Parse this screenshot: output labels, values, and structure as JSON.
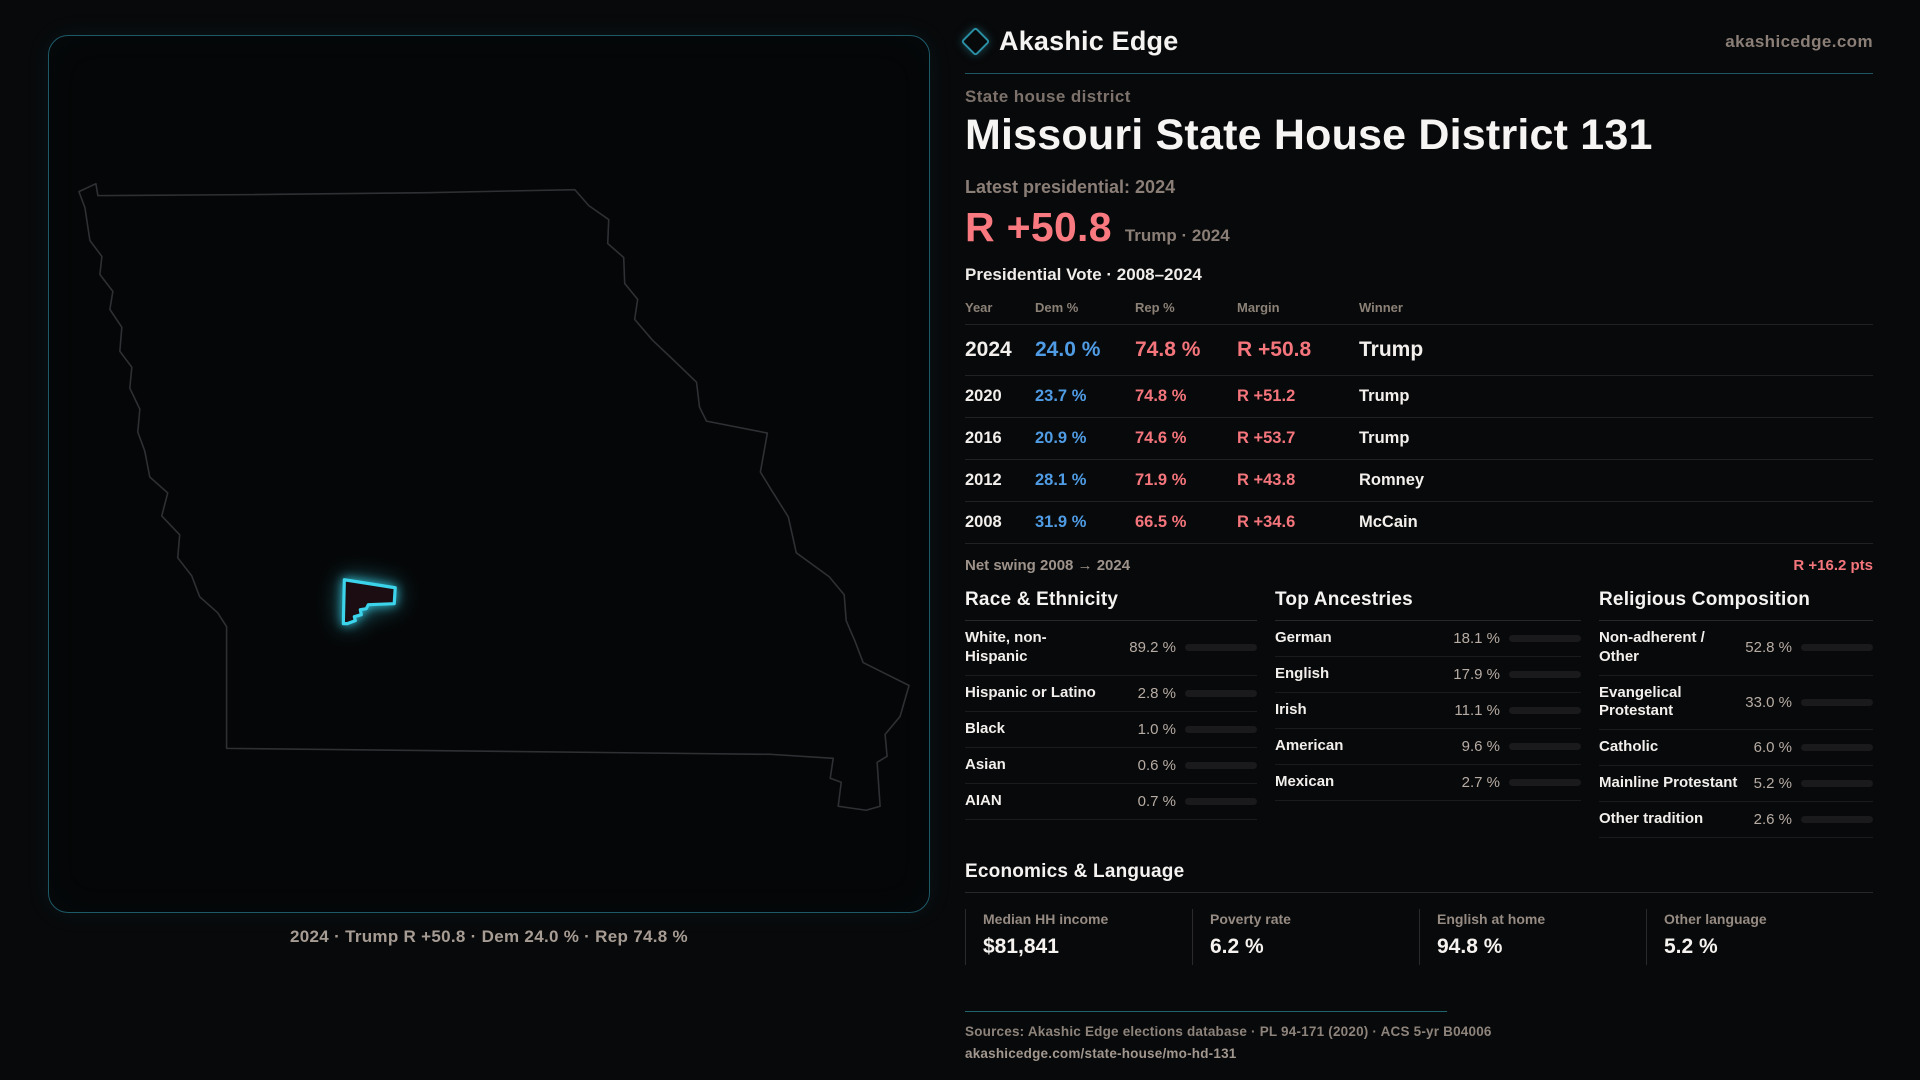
{
  "accent": {
    "red": "#f8797f",
    "blue": "#4f9ce5",
    "teal": "#3bd4ea"
  },
  "header": {
    "brand": "Akashic Edge",
    "site": "akashicedge.com",
    "eyebrow": "State house district",
    "title": "Missouri State House District 131",
    "latest_label": "Latest presidential: 2024",
    "margin_big": "R +50.8",
    "margin_sub": "Trump · 2024"
  },
  "map": {
    "caption": "2024 · Trump R +50.8 · Dem 24.0 % · Rep 74.8 %"
  },
  "vote_table": {
    "title": "Presidential Vote · 2008–2024",
    "columns": {
      "year": "Year",
      "dem": "Dem %",
      "rep": "Rep %",
      "margin": "Margin",
      "winner": "Winner"
    },
    "rows": [
      {
        "year": "2024",
        "dem": "24.0 %",
        "rep": "74.8 %",
        "margin": "R +50.8",
        "winner": "Trump"
      },
      {
        "year": "2020",
        "dem": "23.7 %",
        "rep": "74.8 %",
        "margin": "R +51.2",
        "winner": "Trump"
      },
      {
        "year": "2016",
        "dem": "20.9 %",
        "rep": "74.6 %",
        "margin": "R +53.7",
        "winner": "Trump"
      },
      {
        "year": "2012",
        "dem": "28.1 %",
        "rep": "71.9 %",
        "margin": "R +43.8",
        "winner": "Romney"
      },
      {
        "year": "2008",
        "dem": "31.9 %",
        "rep": "66.5 %",
        "margin": "R +34.6",
        "winner": "McCain"
      }
    ],
    "swing_label": "Net swing 2008 → 2024",
    "swing_value": "R +16.2 pts"
  },
  "demographics": {
    "race": {
      "title": "Race & Ethnicity",
      "rows": [
        {
          "label": "White, non-Hispanic",
          "value": "89.2 %",
          "bar_pct": 89.2,
          "bar_color": "#aebdd3"
        },
        {
          "label": "Hispanic or Latino",
          "value": "2.8 %",
          "bar_pct": 2.8,
          "bar_color": "#e3a23c"
        },
        {
          "label": "Black",
          "value": "1.0 %",
          "bar_pct": 1.0,
          "bar_color": "#7d74e8"
        },
        {
          "label": "Asian",
          "value": "0.6 %",
          "bar_pct": 0.6,
          "bar_color": "#9fb4cf"
        },
        {
          "label": "AIAN",
          "value": "0.7 %",
          "bar_pct": 0.7,
          "bar_color": "#9fb4cf"
        }
      ]
    },
    "ancestry": {
      "title": "Top Ancestries",
      "rows": [
        {
          "label": "German",
          "value": "18.1 %",
          "bar_pct": 18.1,
          "bar_color": "#9fb7d8"
        },
        {
          "label": "English",
          "value": "17.9 %",
          "bar_pct": 17.9,
          "bar_color": "#9fb7d8"
        },
        {
          "label": "Irish",
          "value": "11.1 %",
          "bar_pct": 11.1,
          "bar_color": "#9fb7d8"
        },
        {
          "label": "American",
          "value": "9.6 %",
          "bar_pct": 9.6,
          "bar_color": "#9fb7d8"
        },
        {
          "label": "Mexican",
          "value": "2.7 %",
          "bar_pct": 2.7,
          "bar_color": "#e3a23c"
        }
      ]
    },
    "religion": {
      "title": "Religious Composition",
      "rows": [
        {
          "label": "Non-adherent / Other",
          "value": "52.8 %",
          "bar_pct": 52.8,
          "bar_color": "#8a97ab"
        },
        {
          "label": "Evangelical Protestant",
          "value": "33.0 %",
          "bar_pct": 33.0,
          "bar_color": "#ef6a72"
        },
        {
          "label": "Catholic",
          "value": "6.0 %",
          "bar_pct": 6.0,
          "bar_color": "#e8b13e"
        },
        {
          "label": "Mainline Protestant",
          "value": "5.2 %",
          "bar_pct": 5.2,
          "bar_color": "#4f9ce5"
        },
        {
          "label": "Other tradition",
          "value": "2.6 %",
          "bar_pct": 2.6,
          "bar_color": "#9aa3ad"
        }
      ]
    }
  },
  "economics": {
    "title": "Economics & Language",
    "stats": [
      {
        "label": "Median HH income",
        "value": "$81,841"
      },
      {
        "label": "Poverty rate",
        "value": "6.2 %"
      },
      {
        "label": "English at home",
        "value": "94.8 %"
      },
      {
        "label": "Other language",
        "value": "5.2 %"
      }
    ]
  },
  "footer": {
    "sources": "Sources: Akashic Edge elections database · PL 94-171 (2020) · ACS 5-yr B04006",
    "url": "akashicedge.com/state-house/mo-hd-131"
  }
}
